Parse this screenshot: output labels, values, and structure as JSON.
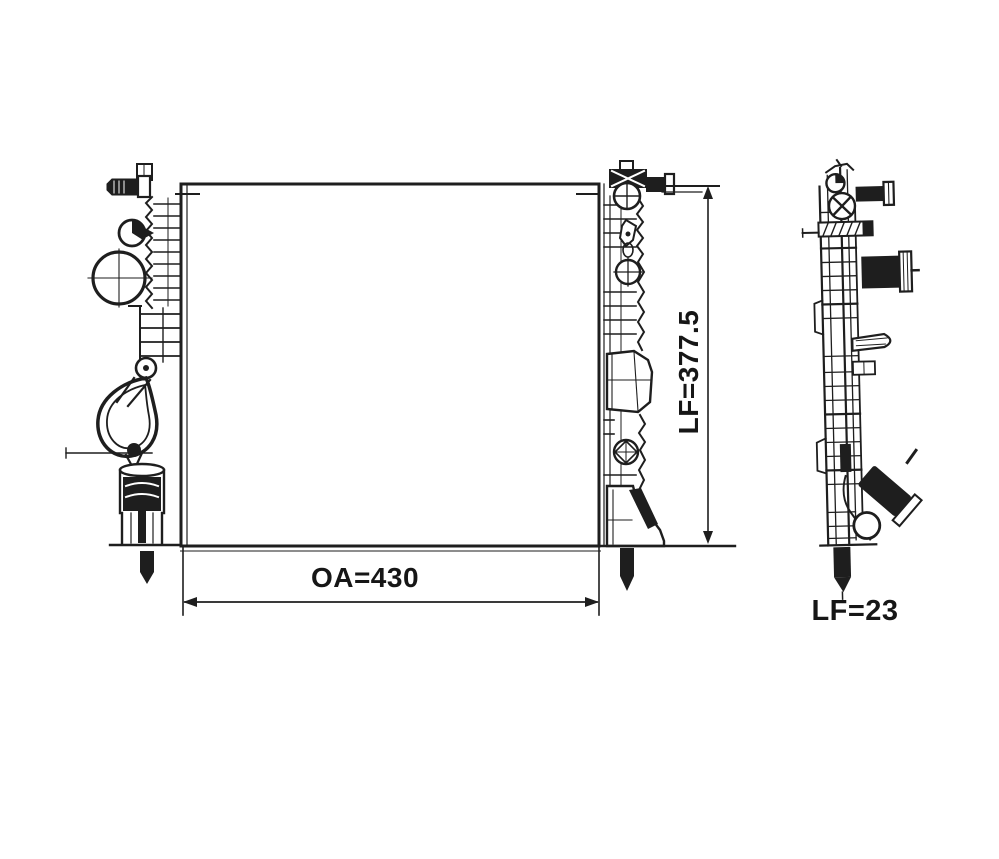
{
  "canvas": {
    "background_color": "#ffffff",
    "line_color": "#1e1e1e",
    "label_color": "#161616"
  },
  "views": {
    "front": {
      "name": "radiator front view"
    },
    "side": {
      "name": "radiator side profile view"
    }
  },
  "dimension_labels": {
    "overall_width": "OA=430",
    "core_height": "LF=377.5",
    "depth": "LF=23"
  }
}
